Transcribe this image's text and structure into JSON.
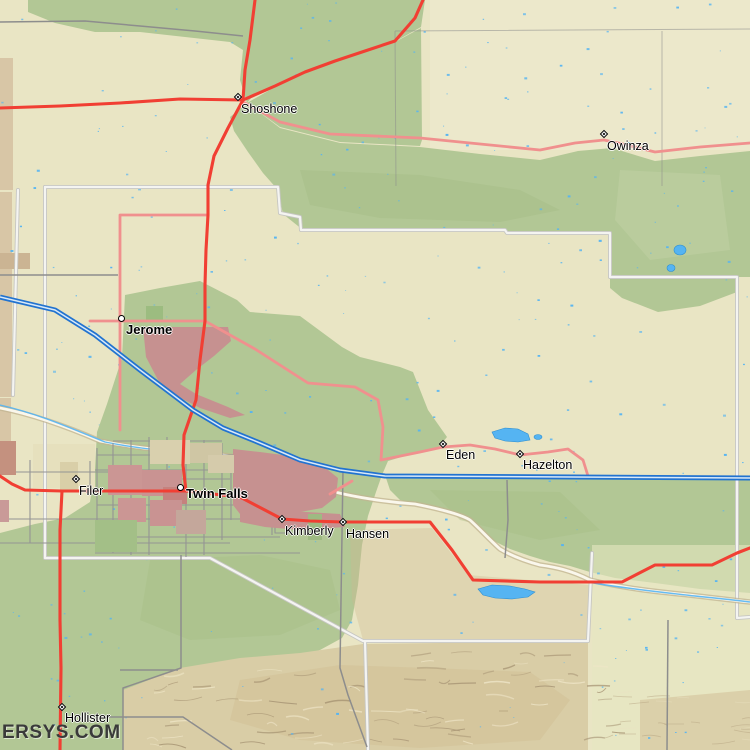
{
  "map_type": "regional road and terrain map",
  "region": "Twin Falls / Jerome area, Idaho",
  "watermark": "ERSYS.COM",
  "colors": {
    "land_tan": "#e9e5c4",
    "land_green": "#b2c795",
    "land_green_dark": "#a4bd85",
    "hills_brown": "#d9cda6",
    "urban_red": "#c69190",
    "road_red": "#f13f33",
    "road_pink": "#f0908e",
    "interstate_blue": "#2273d0",
    "water_blue": "#55b4f2",
    "county_line_white": "#f4f4f1",
    "gray_road": "#8d8d8d",
    "label_color": "#000000",
    "watermark_color": "#3a3a3a"
  },
  "places": [
    {
      "name": "Shoshone",
      "x": 238,
      "y": 97,
      "marker": "diamond",
      "bold": false,
      "dx": 3,
      "dy": 5
    },
    {
      "name": "Owinza",
      "x": 604,
      "y": 134,
      "marker": "diamond",
      "bold": false,
      "dx": 3,
      "dy": 5
    },
    {
      "name": "Jerome",
      "x": 121,
      "y": 318,
      "marker": "circle",
      "bold": true,
      "dx": 5,
      "dy": 4
    },
    {
      "name": "Eden",
      "x": 443,
      "y": 444,
      "marker": "diamond",
      "bold": false,
      "dx": 3,
      "dy": 4
    },
    {
      "name": "Hazelton",
      "x": 520,
      "y": 454,
      "marker": "diamond",
      "bold": false,
      "dx": 3,
      "dy": 4
    },
    {
      "name": "Filer",
      "x": 76,
      "y": 479,
      "marker": "diamond",
      "bold": false,
      "dx": 3,
      "dy": 5
    },
    {
      "name": "Twin Falls",
      "x": 180,
      "y": 487,
      "marker": "circle",
      "bold": true,
      "dx": 6,
      "dy": -1
    },
    {
      "name": "Kimberly",
      "x": 282,
      "y": 519,
      "marker": "diamond",
      "bold": false,
      "dx": 3,
      "dy": 5
    },
    {
      "name": "Hansen",
      "x": 343,
      "y": 522,
      "marker": "diamond",
      "bold": false,
      "dx": 3,
      "dy": 5
    },
    {
      "name": "Hollister",
      "x": 62,
      "y": 707,
      "marker": "diamond",
      "bold": false,
      "dx": 3,
      "dy": 4
    }
  ]
}
